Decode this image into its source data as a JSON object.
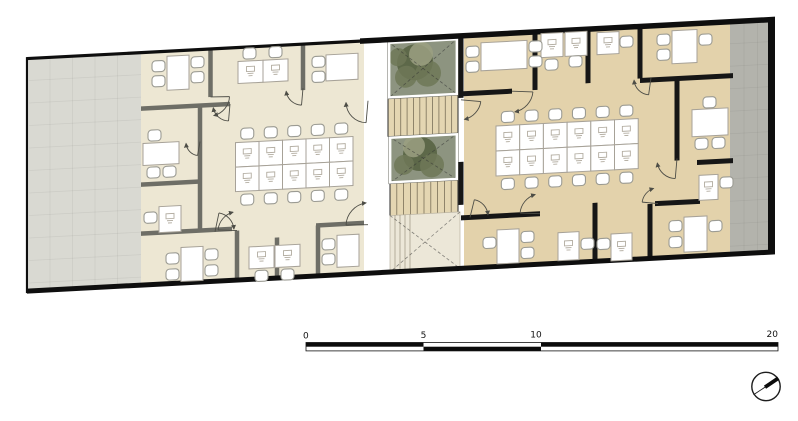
{
  "page": {
    "kind": "architectural-floor-plan",
    "background": "#ffffff"
  },
  "scale_bar": {
    "labels": [
      "0",
      "5",
      "10",
      "20"
    ],
    "tick_values": [
      0,
      5,
      10,
      20
    ]
  },
  "compass": {
    "icon": "north-arrow-icon",
    "needle_direction": "upper-right"
  },
  "plan": {
    "left_wing": {
      "workstation_cluster": {
        "rows": 2,
        "cols": 5,
        "desks": 10
      },
      "perimeter_rooms": 8
    },
    "right_wing": {
      "workstation_cluster": {
        "rows": 2,
        "cols": 6,
        "desks": 12
      },
      "perimeter_rooms": 8
    },
    "core": {
      "courtyards": 2,
      "stair_flights": 2,
      "ramps": 1
    }
  },
  "colors": {
    "page_bg": "#ffffff",
    "outline": "#0e0e0e",
    "paving_left": "#d9d9d2",
    "paving_right": "#b3b3ac",
    "floor_left": "#ede7d3",
    "floor_right": "#e3d2ab",
    "wall_left": "#6e6e66",
    "wall_right": "#161616",
    "courtyard_base": "#8d9480",
    "tree_dark": "#55603f",
    "tree_mid": "#6e7857",
    "tree_light": "#9ba081",
    "stair_fill": "#e4d6b2",
    "stair_line": "#7a7059",
    "ramp_fill": "#ece7d8",
    "furniture_fill": "#ffffff",
    "furniture_stroke": "#a7a298",
    "chair_stroke": "#9b9b93",
    "door_color": "#4d4d46",
    "glyph": "#b2aca0",
    "scale_black": "#0b0b0b"
  }
}
